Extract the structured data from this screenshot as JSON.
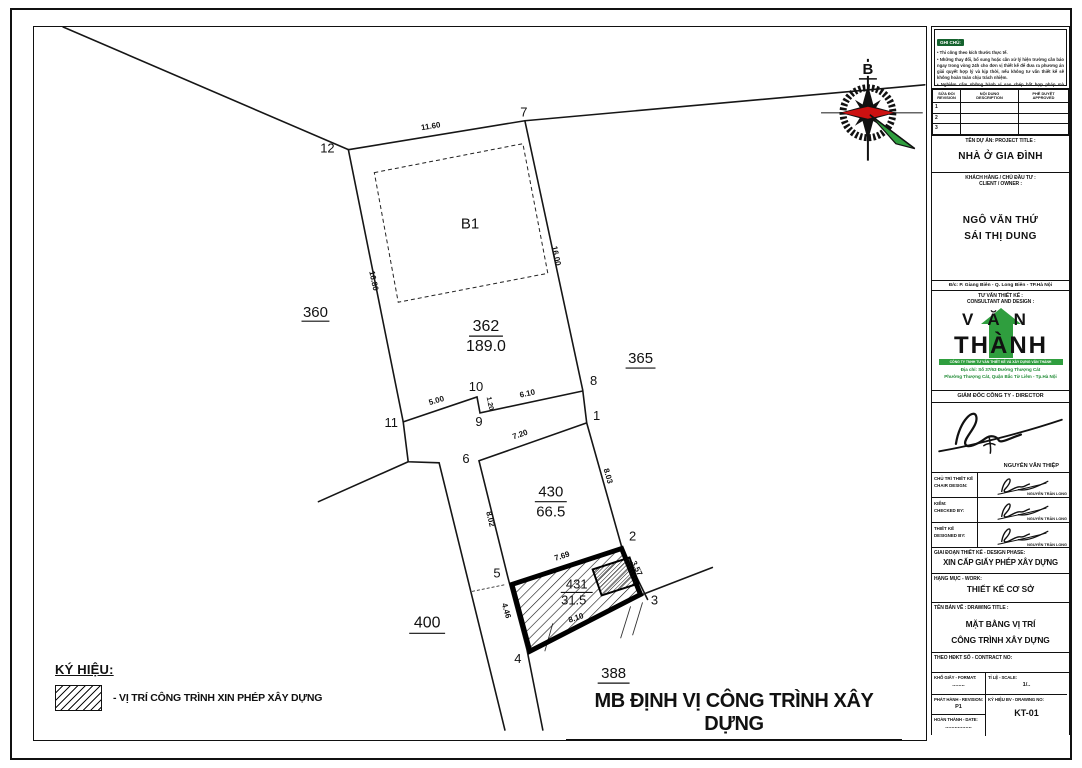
{
  "sheet": {
    "main_title": "MB ĐỊNH VỊ CÔNG TRÌNH XÂY DỰNG",
    "legend": {
      "heading": "KÝ HIỆU:",
      "item_label": "- VỊ TRÍ CÔNG TRÌNH XIN PHÉP XÂY DỰNG"
    },
    "compass_north": "B"
  },
  "plan": {
    "building": "B1",
    "parcels": {
      "p360": "360",
      "p362": "362",
      "p362_area": "189.0",
      "p365": "365",
      "p400": "400",
      "p388": "388",
      "p430": "430",
      "p430_area": "66.5",
      "p431": "431",
      "p431_area": "31.5"
    },
    "points": {
      "p1": "1",
      "p2": "2",
      "p3": "3",
      "p4": "4",
      "p5": "5",
      "p6": "6",
      "p7": "7",
      "p8": "8",
      "p9": "9",
      "p10": "10",
      "p11": "11",
      "p12": "12"
    },
    "dims": {
      "d1160": "11.60",
      "d1680": "16.80",
      "d1600": "16.00",
      "d500": "5.00",
      "d120": "1.20",
      "d610": "6.10",
      "d720": "7.20",
      "d803": "8.03",
      "d802": "8.02",
      "d769": "7.69",
      "d357": "3.57",
      "d810": "8.10",
      "d446": "4.46"
    }
  },
  "titleblock": {
    "notes": {
      "heading": "GHI CHÚ:",
      "n1": "• Thi công theo kích thước thực tế.",
      "n2": "• Những thay đổi, bổ sung hoặc cần xử lý hiện trường cần báo ngay trong vòng 24h cho đơn vị thiết kế để đưa ra phương án giải quyết hợp lý và kịp thời, nếu không tư vấn thiết kế sẽ không hoàn toàn chịu trách nhiệm.",
      "n3": "• Nghiêm cấm những hành vi sao chép bất hợp pháp mà không được sự đồng ý của Cty TVXD VĂN THÀNH."
    },
    "revision_table": {
      "h1a": "SỬA ĐỔI",
      "h1b": "REVISION",
      "h2a": "NỘI DUNG",
      "h2b": "DESCRIPTION",
      "h3a": "PHÊ DUYỆT",
      "h3b": "APPROVED",
      "r1": "1",
      "r2": "2",
      "r3": "3"
    },
    "project_label": "TÊN DỰ ÁN: PROJECT TITLE :",
    "project_value": "NHÀ Ở GIA ĐÌNH",
    "client_label_vi": "KHÁCH HÀNG / CHỦ ĐẦU TƯ :",
    "client_label_en": "CLIENT / OWNER :",
    "owner1": "NGÔ VĂN THỨ",
    "owner2": "SÁI THỊ DUNG",
    "client_address": "Đ/c: P. Giang Biên - Q. Long Biên - TP.Hà Nội",
    "consultant_label_vi": "TƯ VẤN THIẾT KẾ :",
    "consultant_label_en": "CONSULTANT AND DESIGN :",
    "logo_line1": "VĂN",
    "logo_line2": "THÀNH",
    "company_band": "CÔNG TY TNHH TƯ VẤN THIẾT KẾ VÀ XÂY DỰNG VĂN THÀNH",
    "company_addr1": "Địa chỉ: Số 37/63 Đường Thượng Cát",
    "company_addr2": "Phường Thượng Cát, Quận Bắc Từ Liêm - Tp.Hà Nội",
    "director_label": "GIÁM ĐỐC CÔNG TY - DIRECTOR",
    "director_name": "NGUYỄN VĂN THIỆP",
    "sig1_label_vi": "CHỦ TRÌ THIẾT KẾ",
    "sig1_label_en": "CHAIR DESIGN:",
    "sig1_name": "NGUYỄN TRẦN LONG",
    "sig2_label_vi": "KIỂM:",
    "sig2_label_en": "CHECKED BY:",
    "sig2_name": "NGUYỄN TRẦN LONG",
    "sig3_label_vi": "THIẾT KẾ",
    "sig3_label_en": "DESIGNED BY:",
    "sig3_name": "NGUYỄN TRẦN LONG",
    "phase_label": "GIAI ĐOẠN THIẾT KẾ - DESIGN PHASE:",
    "phase_value": "XIN CẤP GIẤY PHÉP XÂY DỰNG",
    "work_label": "HẠNG MỤC - WORK:",
    "work_value": "THIẾT KẾ CƠ SỞ",
    "dt_label": "TÊN BẢN VẼ : DRAWING TITLE :",
    "dt_value1": "MẶT BẰNG VỊ TRÍ",
    "dt_value2": "CÔNG TRÌNH XÂY DỰNG",
    "contract_label": "THEO HĐKT SỐ - CONTRACT NO:",
    "format_label": "KHỔ GIẤY - FORMAT:",
    "format_value": "........",
    "scale_label": "TỈ LỆ - SCALE:",
    "scale_value": "1/..",
    "rev_label": "PHÁT HÀNH - REVISION:",
    "rev_value": "P1",
    "no_label": "KÝ HIỆU BV - DRAWING NO:",
    "no_value": "KT-01",
    "date_label": "HOÀN THÀNH - DATE:",
    "date_value": "................."
  },
  "colors": {
    "line": "#111111",
    "logo_green": "#2f9e3e",
    "compass_red": "#cc1111"
  }
}
